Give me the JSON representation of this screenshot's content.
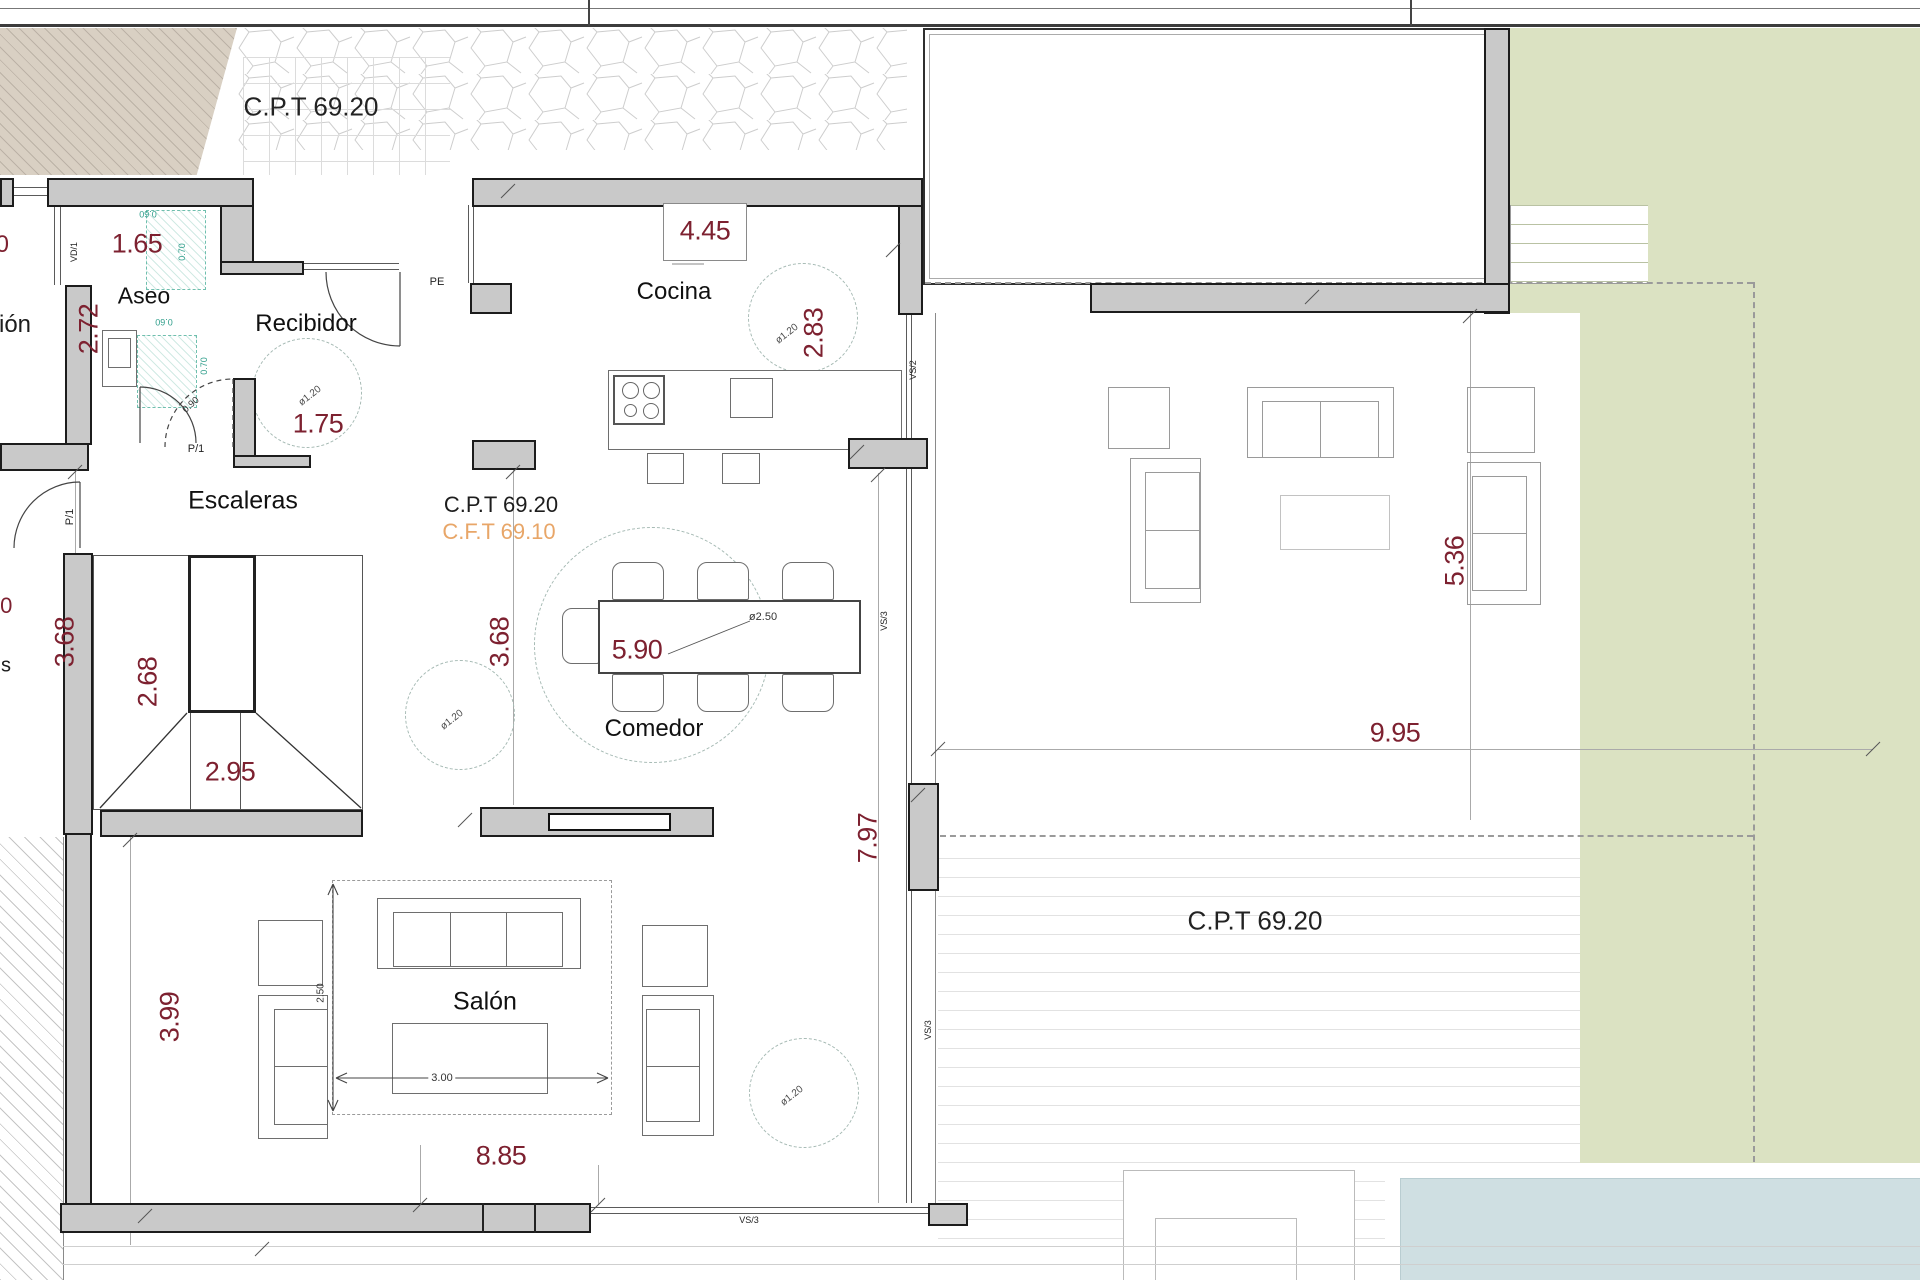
{
  "labels": {
    "cpt_top": "C.P.T 69.20",
    "cpt_mid": "C.P.T 69.20",
    "cft_mid": "C.F.T 69.10",
    "cpt_right": "C.P.T 69.20"
  },
  "rooms": {
    "aseo": "Aseo",
    "recibidor": "Recibidor",
    "cocina": "Cocina",
    "escaleras": "Escaleras",
    "comedor": "Comedor",
    "salon": "Salón"
  },
  "dims": {
    "d165": "1.65",
    "d272": "2.72",
    "d175": "1.75",
    "d445": "4.45",
    "d283": "2.83",
    "d368a": "3.68",
    "d368b": "3.68",
    "d268": "2.68",
    "d295": "2.95",
    "d590": "5.90",
    "d995": "9.95",
    "d797": "7.97",
    "d536": "5.36",
    "d399": "3.99",
    "d885": "8.85",
    "d250": "2.50",
    "d300": "3.00",
    "dfi250": "ø2.50",
    "dfi120a": "ø1.20",
    "dfi120b": "ø1.20",
    "dfi120c": "ø1.20",
    "dfi120d": "ø1.20",
    "d060a": "0.60",
    "d060b": "0.60",
    "d070a": "0.70",
    "d070b": "0.70",
    "d090": "0.90"
  },
  "codes": {
    "vd1": "VD/1",
    "pe": "PE",
    "p1a": "P/1",
    "p1b": "P/1",
    "vs2": "VS/2",
    "vs3a": "VS/3",
    "vs3b": "VS/3",
    "vs3c": "VS/3"
  },
  "partials": {
    "ion": "ión",
    "s": "s",
    "zero_a": "0",
    "zero_b": "0"
  },
  "colors": {
    "dimension_red": "#7d2130",
    "cft_orange": "#e8a668",
    "fixture_teal": "#2f9e8b",
    "wall_gray": "#c9c9c9",
    "lawn_green": "#dbe2c2",
    "pavement_beige": "#d9d0c3",
    "pool_blue": "#cfdfe2"
  }
}
